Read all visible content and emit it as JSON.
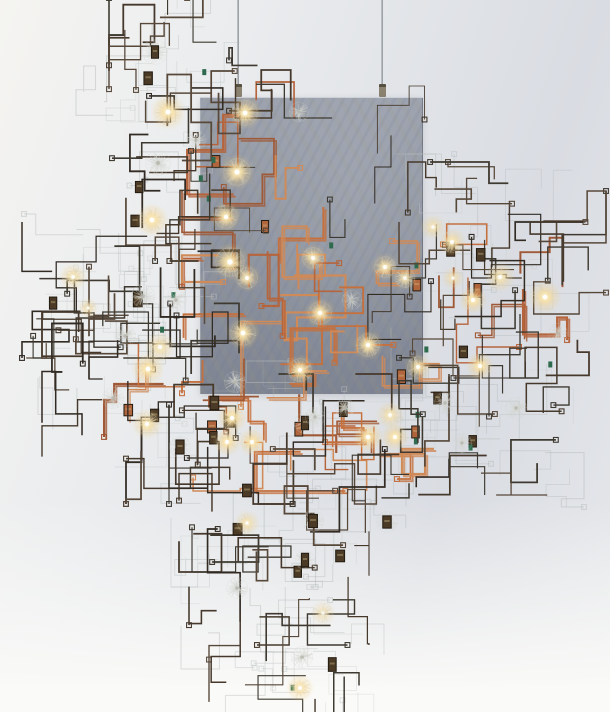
{
  "scene": {
    "width": 610,
    "height": 712,
    "description": "Photograph of a suspended wire-circuit light sculpture: rectilinear dark and copper wires, glowing dandelion-seed glass orbs, small relay components, and a translucent blue-grey resin panel hung from two thin cables against a pale grey studio backdrop.",
    "background": {
      "top_left": "#f5f4f1",
      "upper": "#eaecee",
      "right": "#d9dce2",
      "lower": "#e6e8eb",
      "bottom_fade": "#fafaf8"
    }
  },
  "cables": {
    "color_light": "#c6cacd",
    "color_dark": "#8f959b",
    "items": [
      {
        "x": 238,
        "y1": 0,
        "y2": 97
      },
      {
        "x": 382,
        "y1": 0,
        "y2": 97
      }
    ],
    "ferrule": {
      "width": 7,
      "height": 13,
      "color": "#8b8270",
      "edge": "#55503f"
    }
  },
  "panel": {
    "x": 200,
    "y": 97,
    "width": 223,
    "height": 296,
    "top_color": "#9ba1ad",
    "mid_color": "#8d93a0",
    "bottom_color": "#7e8492",
    "streak_blue": "rgba(110,118,140,0.12)",
    "streak_olive": "rgba(158,155,126,0.12)",
    "edge_highlight": "rgba(218,223,230,0.85)",
    "edge_shadow": "rgba(90,95,108,0.55)"
  },
  "palette": {
    "wire_dark": [
      "#322b24",
      "#46392c",
      "#57483a",
      "#3e3a31"
    ],
    "wire_copper": [
      "#b5643c",
      "#c4703f",
      "#d08a58",
      "#9f5936"
    ],
    "wire_pale": [
      "rgba(183,189,187,0.50)",
      "rgba(199,203,199,0.38)",
      "rgba(168,176,176,0.32)"
    ],
    "component_fill": "#4a3a26",
    "component_edge": "#241c12",
    "component_glint": "rgba(214,192,140,0.38)",
    "chip_green": "#2e6b4e",
    "fluff": "210,212,205",
    "glow_core": "rgba(255,253,243,0.95)",
    "glow_warm": "rgba(255,231,168,0.80)",
    "glow_outer": "rgba(255,213,128,0.28)"
  },
  "render": {
    "seed": 11,
    "widths": {
      "dark": [
        1.1,
        1.8
      ],
      "darkthin": [
        0.8,
        1.2
      ],
      "copper": [
        1.3,
        2.2
      ],
      "pale": [
        0.7,
        1.1
      ]
    },
    "segment_length": [
      10,
      52
    ]
  },
  "wire_clusters": [
    {
      "x": 118,
      "y": 8,
      "w": 115,
      "h": 100,
      "style": "pale",
      "paths": 7
    },
    {
      "x": 90,
      "y": 80,
      "w": 150,
      "h": 270,
      "style": "pale",
      "paths": 16
    },
    {
      "x": 38,
      "y": 228,
      "w": 165,
      "h": 125,
      "style": "pale",
      "paths": 10
    },
    {
      "x": 52,
      "y": 318,
      "w": 175,
      "h": 135,
      "style": "pale",
      "paths": 12
    },
    {
      "x": 175,
      "y": 375,
      "w": 275,
      "h": 120,
      "style": "pale",
      "paths": 18
    },
    {
      "x": 405,
      "y": 168,
      "w": 170,
      "h": 205,
      "style": "pale",
      "paths": 14
    },
    {
      "x": 405,
      "y": 348,
      "w": 165,
      "h": 145,
      "style": "pale",
      "paths": 10
    },
    {
      "x": 185,
      "y": 458,
      "w": 225,
      "h": 115,
      "style": "pale",
      "paths": 12
    },
    {
      "x": 195,
      "y": 540,
      "w": 175,
      "h": 115,
      "style": "pale",
      "paths": 10
    },
    {
      "x": 222,
      "y": 598,
      "w": 145,
      "h": 105,
      "style": "pale",
      "paths": 8
    },
    {
      "x": 196,
      "y": 96,
      "w": 115,
      "h": 295,
      "style": "copper",
      "paths": 13,
      "comps": 2
    },
    {
      "x": 255,
      "y": 225,
      "w": 170,
      "h": 168,
      "style": "copper",
      "paths": 11,
      "comps": 2
    },
    {
      "x": 193,
      "y": 385,
      "w": 240,
      "h": 92,
      "style": "copper",
      "paths": 9,
      "comps": 2
    },
    {
      "x": 418,
      "y": 238,
      "w": 135,
      "h": 112,
      "style": "copper",
      "paths": 6,
      "comps": 1
    },
    {
      "x": 118,
      "y": 328,
      "w": 112,
      "h": 95,
      "style": "copper",
      "paths": 5,
      "comps": 1
    },
    {
      "x": 330,
      "y": 390,
      "w": 100,
      "h": 70,
      "style": "copper",
      "paths": 4,
      "comps": 1
    },
    {
      "x": 205,
      "y": 100,
      "w": 212,
      "h": 288,
      "style": "darkthin",
      "paths": 7
    },
    {
      "x": 123,
      "y": 12,
      "w": 102,
      "h": 96,
      "style": "dark",
      "paths": 9,
      "comps": 1
    },
    {
      "x": 108,
      "y": 85,
      "w": 118,
      "h": 162,
      "style": "dark",
      "paths": 13,
      "comps": 2
    },
    {
      "x": 36,
      "y": 236,
      "w": 132,
      "h": 108,
      "style": "dark",
      "paths": 11,
      "comps": 1
    },
    {
      "x": 103,
      "y": 233,
      "w": 122,
      "h": 132,
      "style": "dark",
      "paths": 11,
      "comps": 1
    },
    {
      "x": 56,
      "y": 326,
      "w": 158,
      "h": 118,
      "style": "dark",
      "paths": 11,
      "comps": 1
    },
    {
      "x": 140,
      "y": 420,
      "w": 90,
      "h": 70,
      "style": "dark",
      "paths": 5,
      "comps": 1
    },
    {
      "x": 183,
      "y": 388,
      "w": 252,
      "h": 102,
      "style": "dark",
      "paths": 15,
      "comps": 3
    },
    {
      "x": 418,
      "y": 176,
      "w": 122,
      "h": 88,
      "style": "dark",
      "paths": 9,
      "comps": 1
    },
    {
      "x": 540,
      "y": 205,
      "w": 52,
      "h": 95,
      "style": "dark",
      "paths": 4
    },
    {
      "x": 413,
      "y": 236,
      "w": 172,
      "h": 128,
      "style": "dark",
      "paths": 13,
      "comps": 2
    },
    {
      "x": 413,
      "y": 353,
      "w": 142,
      "h": 128,
      "style": "dark",
      "paths": 11,
      "comps": 2
    },
    {
      "x": 243,
      "y": 56,
      "w": 85,
      "h": 48,
      "style": "dark",
      "paths": 4
    },
    {
      "x": 193,
      "y": 463,
      "w": 202,
      "h": 95,
      "style": "dark",
      "paths": 11,
      "comps": 2
    },
    {
      "x": 203,
      "y": 543,
      "w": 152,
      "h": 88,
      "style": "dark",
      "paths": 8,
      "comps": 2
    },
    {
      "x": 223,
      "y": 612,
      "w": 122,
      "h": 92,
      "style": "dark",
      "paths": 7,
      "comps": 1
    }
  ],
  "orbs": [
    {
      "x": 155,
      "y": 52,
      "r": 13,
      "lit": false,
      "comp": true
    },
    {
      "x": 168,
      "y": 112,
      "r": 14,
      "lit": true
    },
    {
      "x": 158,
      "y": 163,
      "r": 13,
      "lit": false
    },
    {
      "x": 152,
      "y": 220,
      "r": 13,
      "lit": true
    },
    {
      "x": 196,
      "y": 140,
      "r": 10,
      "lit": false
    },
    {
      "x": 73,
      "y": 277,
      "r": 11,
      "lit": true,
      "g": 0.8
    },
    {
      "x": 88,
      "y": 308,
      "r": 8,
      "lit": true,
      "g": 0.7
    },
    {
      "x": 143,
      "y": 296,
      "r": 12,
      "lit": false
    },
    {
      "x": 176,
      "y": 300,
      "r": 11,
      "lit": false
    },
    {
      "x": 125,
      "y": 336,
      "r": 11,
      "lit": false
    },
    {
      "x": 160,
      "y": 347,
      "r": 12,
      "lit": true,
      "g": 0.8
    },
    {
      "x": 148,
      "y": 369,
      "r": 13,
      "lit": true
    },
    {
      "x": 147,
      "y": 424,
      "r": 12,
      "lit": true,
      "g": 0.9
    },
    {
      "x": 113,
      "y": 398,
      "r": 11,
      "lit": false
    },
    {
      "x": 180,
      "y": 447,
      "r": 11,
      "lit": false,
      "comp": true
    },
    {
      "x": 245,
      "y": 113,
      "r": 13,
      "lit": true
    },
    {
      "x": 299,
      "y": 112,
      "r": 10,
      "lit": false
    },
    {
      "x": 237,
      "y": 172,
      "r": 14,
      "lit": true
    },
    {
      "x": 226,
      "y": 217,
      "r": 12,
      "lit": true
    },
    {
      "x": 230,
      "y": 262,
      "r": 15,
      "lit": true
    },
    {
      "x": 247,
      "y": 278,
      "r": 11,
      "lit": true,
      "g": 0.85
    },
    {
      "x": 243,
      "y": 333,
      "r": 13,
      "lit": true
    },
    {
      "x": 313,
      "y": 258,
      "r": 11,
      "lit": true,
      "g": 0.9
    },
    {
      "x": 320,
      "y": 313,
      "r": 12,
      "lit": true
    },
    {
      "x": 300,
      "y": 370,
      "r": 12,
      "lit": true
    },
    {
      "x": 368,
      "y": 345,
      "r": 12,
      "lit": true
    },
    {
      "x": 385,
      "y": 267,
      "r": 11,
      "lit": true,
      "g": 0.9
    },
    {
      "x": 405,
      "y": 278,
      "r": 10,
      "lit": true,
      "g": 0.8
    },
    {
      "x": 352,
      "y": 300,
      "r": 10,
      "lit": false
    },
    {
      "x": 418,
      "y": 367,
      "r": 11,
      "lit": true,
      "g": 0.85
    },
    {
      "x": 235,
      "y": 382,
      "r": 11,
      "lit": false
    },
    {
      "x": 232,
      "y": 418,
      "r": 12,
      "lit": true
    },
    {
      "x": 227,
      "y": 442,
      "r": 11,
      "lit": true
    },
    {
      "x": 252,
      "y": 442,
      "r": 11,
      "lit": true
    },
    {
      "x": 305,
      "y": 423,
      "r": 11,
      "lit": false,
      "comp": true
    },
    {
      "x": 315,
      "y": 417,
      "r": 10,
      "lit": false
    },
    {
      "x": 368,
      "y": 437,
      "r": 12,
      "lit": true
    },
    {
      "x": 395,
      "y": 437,
      "r": 11,
      "lit": true
    },
    {
      "x": 390,
      "y": 415,
      "r": 11,
      "lit": true,
      "g": 0.8
    },
    {
      "x": 345,
      "y": 408,
      "r": 10,
      "lit": false
    },
    {
      "x": 433,
      "y": 227,
      "r": 10,
      "lit": true,
      "g": 0.75
    },
    {
      "x": 452,
      "y": 242,
      "r": 11,
      "lit": true,
      "g": 0.9
    },
    {
      "x": 453,
      "y": 278,
      "r": 9,
      "lit": true,
      "g": 0.7
    },
    {
      "x": 473,
      "y": 300,
      "r": 11,
      "lit": true
    },
    {
      "x": 500,
      "y": 277,
      "r": 12,
      "lit": true,
      "g": 0.8
    },
    {
      "x": 545,
      "y": 297,
      "r": 13,
      "lit": true
    },
    {
      "x": 558,
      "y": 333,
      "r": 10,
      "lit": false
    },
    {
      "x": 516,
      "y": 408,
      "r": 11,
      "lit": false
    },
    {
      "x": 480,
      "y": 366,
      "r": 11,
      "lit": true
    },
    {
      "x": 445,
      "y": 403,
      "r": 11,
      "lit": false
    },
    {
      "x": 462,
      "y": 443,
      "r": 10,
      "lit": false
    },
    {
      "x": 313,
      "y": 521,
      "r": 11,
      "lit": false,
      "comp": true
    },
    {
      "x": 387,
      "y": 522,
      "r": 11,
      "lit": false,
      "comp": true
    },
    {
      "x": 247,
      "y": 523,
      "r": 10,
      "lit": true,
      "g": 0.8
    },
    {
      "x": 305,
      "y": 560,
      "r": 10,
      "lit": false,
      "comp": true
    },
    {
      "x": 237,
      "y": 588,
      "r": 11,
      "lit": false
    },
    {
      "x": 323,
      "y": 613,
      "r": 10,
      "lit": true,
      "g": 0.6
    },
    {
      "x": 302,
      "y": 657,
      "r": 11,
      "lit": false
    },
    {
      "x": 300,
      "y": 688,
      "r": 11,
      "lit": true,
      "g": 0.9
    }
  ]
}
